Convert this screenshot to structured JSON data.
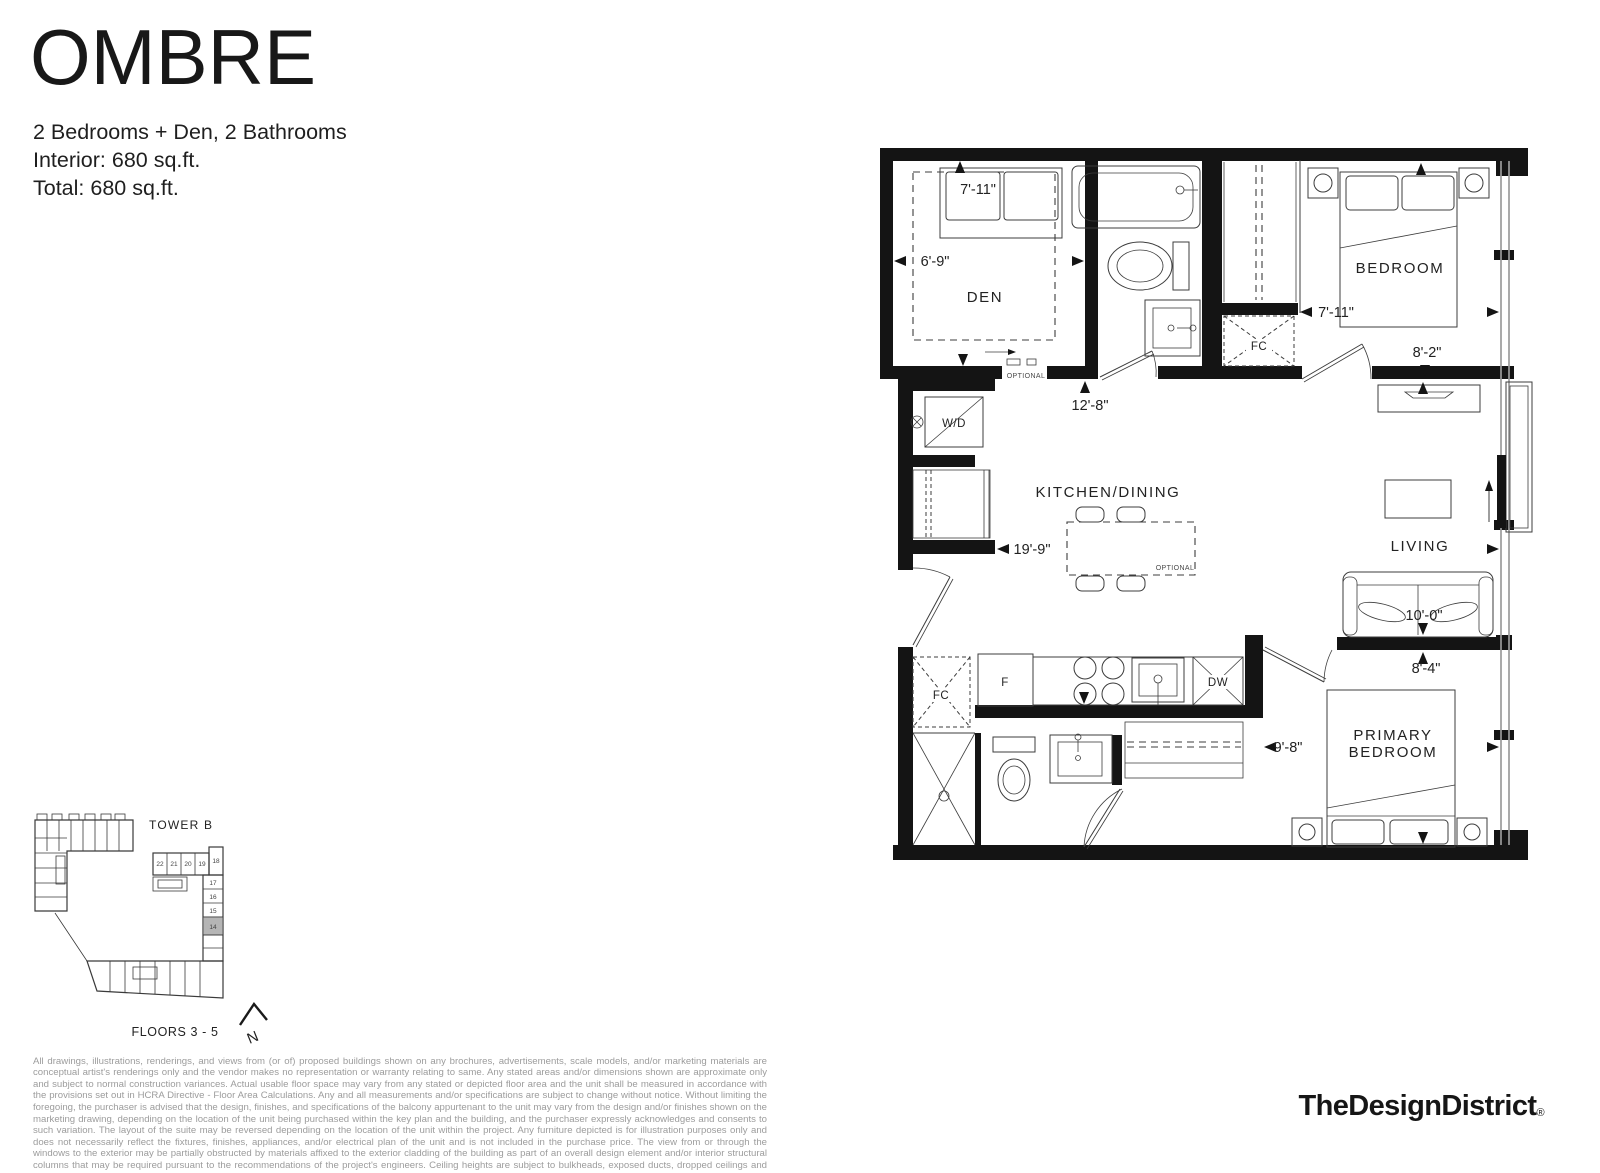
{
  "header": {
    "title": "OMBRE",
    "spec_lines": [
      "2 Bedrooms + Den, 2 Bathrooms",
      "Interior: 680 sq.ft.",
      "Total: 680 sq.ft."
    ]
  },
  "floorplan": {
    "room_labels": {
      "den": "DEN",
      "bedroom": "BEDROOM",
      "kitchen_dining": "KITCHEN/DINING",
      "living": "LIVING",
      "primary_line1": "PRIMARY",
      "primary_line2": "BEDROOM"
    },
    "fixture_labels": {
      "washer_dryer": "W/D",
      "fan_coil": "FC",
      "fridge": "F",
      "dishwasher": "DW"
    },
    "dimensions": {
      "den_depth": "7'-11\"",
      "den_width": "6'-9\"",
      "bath_corridor": "12'-8\"",
      "bedroom_width": "7'-11\"",
      "bedroom_depth": "8'-2\"",
      "suite_width": "19'-9\"",
      "living_depth": "10'-0\"",
      "primary_depth": "8'-4\"",
      "primary_width": "9'-8\""
    },
    "optional_label": "OPTIONAL"
  },
  "keyplan": {
    "tower_label": "TOWER B",
    "floors_label": "FLOORS 3 - 5",
    "north_label": "N",
    "unit_numbers": [
      "22",
      "21",
      "20",
      "19",
      "18",
      "17",
      "16",
      "15",
      "14"
    ],
    "highlighted_unit": "14",
    "highlight_color": "#b5b5b5"
  },
  "disclaimer": "All drawings, illustrations, renderings, and views from (or of) proposed buildings shown on any brochures, advertisements, scale models, and/or marketing materials are conceptual artist's renderings only and the vendor makes no representation or warranty relating to same. Any stated areas and/or dimensions shown are approximate only and subject to normal construction variances. Actual usable floor space may vary from any stated or depicted floor area and the unit shall be measured in accordance with the provisions set out in HCRA Directive - Floor Area Calculations. Any and all measurements and/or specifications are subject to change without notice. Without limiting the foregoing, the purchaser is advised that the design, finishes, and specifications of the balcony appurtenant to the unit may vary from the design and/or finishes shown on the marketing drawing, depending on the location of the unit being purchased within the key plan and the building, and the purchaser expressly acknowledges and consents to such variation. The layout of the suite may be reversed depending on the location of the unit within the project. Any furniture depicted is for illustration purposes only and does not necessarily reflect the fixtures, finishes, appliances, and/or electrical plan of the unit and is not included in the purchase price. The view from or through the windows to the exterior may be partially obstructed by materials affixed to the exterior cladding of the building as part of an overall design element and/or interior structural columns that may be required pursuant to the recommendations of the project's engineers. Ceiling heights are subject to bulkheads, exposed ducts, dropped ceilings and structural beams, as applicable pursuant to the plans. All features and finishes are subject to change without notice. E.&O.E. July, 2022.",
  "logo": {
    "text": "TheDesignDistrict",
    "registered_mark": "®"
  }
}
